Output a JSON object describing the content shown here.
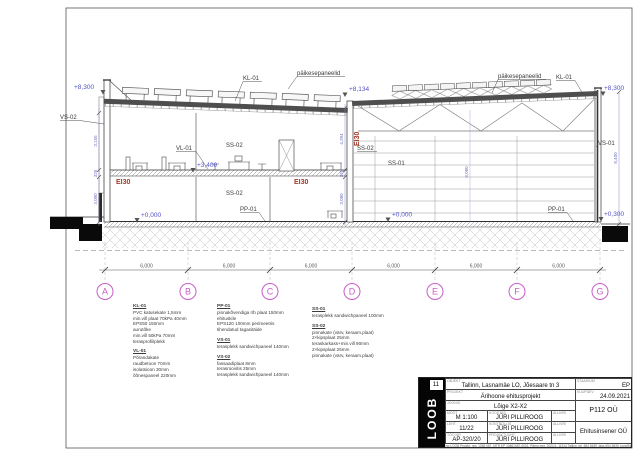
{
  "drawing": {
    "labels": {
      "solar_left": "päikesepaneelid",
      "solar_right": "päikesepaneelid",
      "kl01_left": "KL-01",
      "kl01_right": "KL-01",
      "vs02": "VS-02",
      "vs01": "VS-01",
      "vl01": "VL-01",
      "ss02_upper": "SS-02",
      "ss02_lower": "SS-02",
      "ss02_hall": "SS-02",
      "ss01_hall": "SS-01",
      "pp01_left": "PP-01",
      "pp01_right": "PP-01"
    },
    "fire": {
      "ei30_left": "EI30",
      "ei30_mid": "EI30",
      "ei30_wall": "EI30"
    },
    "elevations": {
      "left_top": "+8,300",
      "mid_top": "+8,134",
      "right_top": "+8,300",
      "mid_floor": "+3,400",
      "ground_left": "+0,000",
      "ground_right": "+0,000",
      "right_bottom": "+0,300"
    },
    "dims": {
      "bays": [
        "6,000",
        "6,000",
        "6,000",
        "6,000",
        "6,000",
        "6,000"
      ],
      "left_wall": [
        "3,155",
        "320",
        "3,080"
      ],
      "mid_wall": [
        "4,394",
        "320",
        "3,080"
      ],
      "right_wall": "8,400",
      "hall_height": "8,080"
    },
    "grid": [
      "A",
      "B",
      "C",
      "D",
      "E",
      "F",
      "G"
    ]
  },
  "legend": {
    "kl01": {
      "title": "KL-01",
      "items": [
        "PVC katusekate 1,5mm",
        "min.vill plaat 70kPa 40mm",
        "EPS50 150mm",
        "aurutõke",
        "min.vill 50kPa 70mm",
        "terasprofiilplekk"
      ]
    },
    "vl01": {
      "title": "VL-01",
      "items": [
        "Põrandakate",
        "raudbetoon 70mm",
        "isolatsioon 30mm",
        "õõnespaneel 220mm"
      ]
    },
    "pp01": {
      "title": "PP-01",
      "items": [
        "pinnakõvendiga r/b plaat 150mm",
        "ehituskile",
        "EPS120 100mm perimeetris",
        "tihendatud tagasitäide"
      ]
    },
    "vs01": {
      "title": "VS-01",
      "items": [
        "terasplekk sandwichpaneel 140mm"
      ]
    },
    "vs02": {
      "title": "VS-02",
      "items": [
        "fassaadiplaat 8mm",
        "terasroovitis 25mm",
        "terasplekk sandwichpaneel 140mm"
      ]
    },
    "ss01": {
      "title": "SS-01",
      "items": [
        "terasplekk sandwichpaneel 100mm"
      ]
    },
    "ss02": {
      "title": "SS-02",
      "items": [
        "pinnakate (värv, keraam.plaat)",
        "2×kipsplaat 25mm",
        "teraskarkass+min.vill 90mm",
        "2×kipsplaat 25mm",
        "pinnakate (värv, keraam.plaat)"
      ]
    }
  },
  "titleblock": {
    "logo_text": "LOOB",
    "sheet_no": "11",
    "object": "Tallinn, Lasnamäe LO, Jõesaare tn 3",
    "stage": "EP",
    "project": "Ärihoone ehitusprojekt",
    "date": "24.09.2021",
    "drawing_title": "Lõige X2-X2",
    "company": "P112 OÜ",
    "scale": "M 1:100",
    "sheet": "11/22",
    "work_no": "AP-320/20",
    "name1": "JÜRI PILLIROOG",
    "name2": "JÜRI PILLIROOG",
    "name3": "JÜRI PILLIROOG",
    "engineer": "Ehitusinsener OÜ",
    "small_labels": {
      "object": "OBJEKT",
      "stage": "STAADIUM",
      "project": "PROJEKT",
      "date": "KUUPÄEV",
      "drawing": "JOONIS",
      "scale": "MÕÕT",
      "sheet": "LEHT",
      "work_no": "TÖÖ NR",
      "name1": "KOOSTAS",
      "name2": "KONTROLLIS",
      "name3": "PROJEKTIJUHT",
      "sign": "ALLKIRI"
    },
    "footer": "Osaühing LOOB Projekt, reg. 1065 087, MTR EP 10861987-0001, Pärnu mnt. 2021/1, 11314 Tallinn, tel. 654 5639, faks 654 5639, loob@loob.ee"
  },
  "colors": {
    "ink": "#3a3a3a",
    "dim_blue": "#5252c8",
    "grid_magenta": "#c75fc7",
    "fire_red": "#a03a28"
  }
}
